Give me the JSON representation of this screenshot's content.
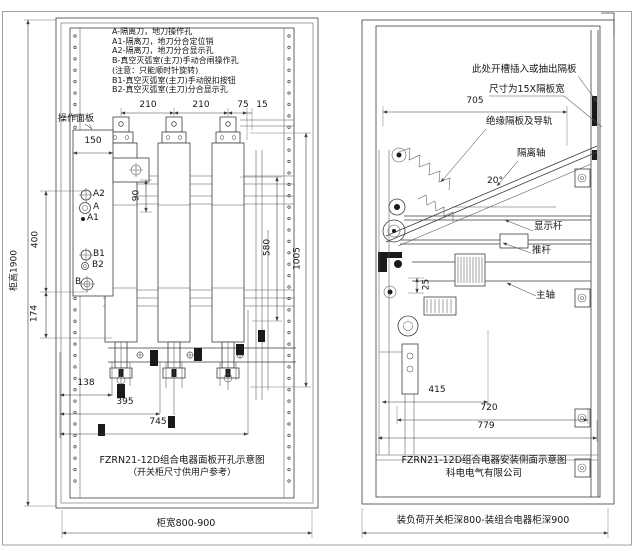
{
  "page": {
    "background": "#ffffff",
    "line_color": "#3d3d3d"
  },
  "left_view": {
    "legend_lines": [
      "A-隔离刀，地刀操作孔",
      "A1-隔离刀，地刀分合定位销",
      "A2-隔离刀，地刀分合显示孔",
      "B-真空灭弧室(主刀)手动合闸操作孔",
      "(注意：只能顺时针旋转)",
      "B1-真空灭弧室(主刀)手动脱扣按钮",
      "B2-真空灭弧室(主刀)分合显示孔"
    ],
    "panel_label": "操作面板",
    "holes": {
      "a2": "A2",
      "a": "A",
      "a1": "A1",
      "b1": "B1",
      "b2": "B2",
      "b": "B"
    },
    "dims": {
      "top1": "210",
      "top2": "210",
      "top3": "75",
      "top4": "15",
      "panel_width": "150",
      "pole": "90",
      "v400": "400",
      "v174": "174",
      "v580": "580",
      "v1005": "1005",
      "b138": "138",
      "b395": "395",
      "b745": "745",
      "cabinet_height": "柜高1900",
      "cabinet_width": "柜宽800-900"
    },
    "caption1": "FZRN21-12D组合电器面板开孔示意图",
    "caption2": "（开关柜尺寸供用户参考）"
  },
  "right_view": {
    "slot_note1": "此处开槽插入或抽出隔板",
    "slot_note2": "尺寸为15X隔板宽",
    "labels": {
      "rail": "绝缘隔板及导轨",
      "iso_shaft": "隔离轴",
      "angle": "20°",
      "indicator_rod": "显示杆",
      "push_rod": "推杆",
      "main_shaft": "主轴"
    },
    "dims": {
      "d705": "705",
      "d25": "25",
      "d415": "415",
      "d720": "720",
      "d779": "779",
      "cabinet_depth": "装负荷开关柜深800-装组合电器柜深900"
    },
    "caption1": "FZRN21-12D组合电器安装侧面示意图",
    "caption2": "科电电气有限公司"
  }
}
